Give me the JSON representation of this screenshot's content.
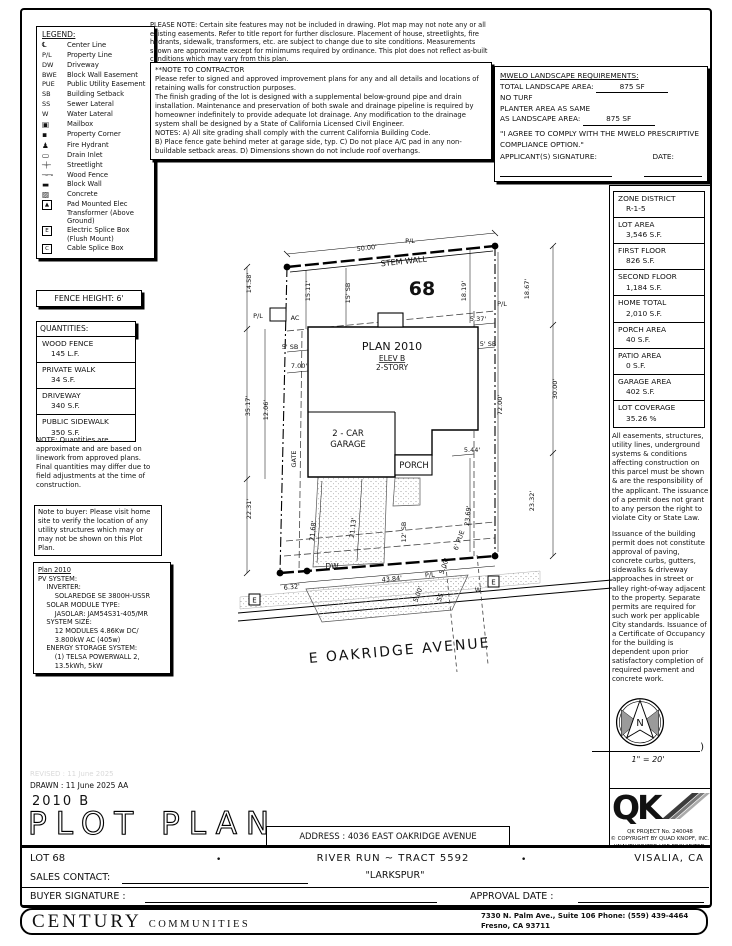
{
  "legend": {
    "title": "LEGEND:",
    "items": [
      {
        "sym": "℄",
        "label": "Center Line"
      },
      {
        "sym": "P/L",
        "cls": "sm",
        "label": "Property Line"
      },
      {
        "sym": "DW",
        "cls": "sm",
        "label": "Driveway"
      },
      {
        "sym": "BWE",
        "cls": "sm",
        "label": "Block Wall Easement"
      },
      {
        "sym": "PUE",
        "cls": "sm",
        "label": "Public Utility Easement"
      },
      {
        "sym": "SB",
        "cls": "sm",
        "label": "Building Setback"
      },
      {
        "sym": "SS",
        "cls": "sm",
        "label": "Sewer Lateral"
      },
      {
        "sym": "W",
        "cls": "sm",
        "label": "Water Lateral"
      },
      {
        "sym": "▣",
        "cls": "ic",
        "label": "Mailbox"
      },
      {
        "sym": "▪",
        "cls": "ic",
        "label": "Property Corner"
      },
      {
        "sym": "♟",
        "cls": "ic",
        "label": "Fire Hydrant"
      },
      {
        "sym": "▭",
        "cls": "ic",
        "label": "Drain Inlet"
      },
      {
        "sym": "─┼─",
        "cls": "tiny",
        "label": "Streetlight"
      },
      {
        "sym": "─∘─∘",
        "cls": "tiny",
        "label": "Wood Fence"
      },
      {
        "sym": "▬",
        "cls": "ic",
        "label": "Block Wall"
      },
      {
        "sym": "▨",
        "cls": "ic",
        "label": "Concrete"
      },
      {
        "sym": "▲",
        "cls": "bx",
        "label": "Pad Mounted Elec Transformer (Above Ground)"
      },
      {
        "sym": "E",
        "cls": "bx",
        "label": "Electric Splice Box (Flush Mount)"
      },
      {
        "sym": "C",
        "cls": "bx",
        "label": "Cable Splice Box"
      }
    ]
  },
  "top_note": "PLEASE NOTE:  Certain site features may not be included in drawing.  Plot map may not note any or all existing easements.  Refer to title report for further disclosure.  Placement of house, streetlights, fire hydrants, sidewalk, transformers, etc. are subject to change due to site conditions.  Measurements shown are approximate except for minimums required by ordinance.  This plot does not reflect as-built conditions which may vary from this plan.",
  "contractor": {
    "title": "**NOTE TO CONTRACTOR",
    "paras": [
      "Please refer to signed and approved improvement plans for any and all details and locations of retaining walls for construction purposes.",
      "The finish grading of the lot is designed with a supplemental below-ground pipe and drain installation.  Maintenance and preservation of both swale and drainage pipeline is required by homeowner indefinitely to provide adequate lot drainage.  Any modification to the drainage system shall be designed by a State of California Licensed Civil Engineer.",
      "NOTES:  A) All site grading shall comply with the current California Building Code.",
      "B) Place fence gate behind meter at garage side, typ.  C) Do not place A/C pad in any non-buildable setback areas.  D) Dimensions shown do not include roof overhangs."
    ]
  },
  "mwelo": {
    "title": "MWELO LANDSCAPE REQUIREMENTS:",
    "row1_label": "TOTAL LANDSCAPE AREA:",
    "row1_value": "875 SF",
    "row2": "NO TURF",
    "row3a": "PLANTER AREA AS SAME",
    "row3b": "AS LANDSCAPE AREA:",
    "row3_value": "875 SF",
    "quote": "\"I AGREE TO COMPLY WITH THE MWELO PRESCRIPTIVE COMPLIANCE OPTION.\"",
    "sig_label": "APPLICANT(S) SIGNATURE:",
    "date_label": "DATE:"
  },
  "zone_table": {
    "rows": [
      {
        "label": "ZONE DISTRICT",
        "value": "R-1-5"
      },
      {
        "label": "LOT AREA",
        "value": "3,546 S.F."
      },
      {
        "label": "FIRST FLOOR",
        "value": "826 S.F."
      },
      {
        "label": "SECOND FLOOR",
        "value": "1,184 S.F."
      },
      {
        "label": "HOME TOTAL",
        "value": "2,010 S.F."
      },
      {
        "label": "PORCH AREA",
        "value": "40 S.F."
      },
      {
        "label": "PATIO AREA",
        "value": "0 S.F."
      },
      {
        "label": "GARAGE AREA",
        "value": "402 S.F."
      },
      {
        "label": "LOT COVERAGE",
        "value": "35.26 %"
      }
    ]
  },
  "right_notes": {
    "p1": "All easements, structures, utility lines, underground systems & conditions affecting construction on this parcel must be shown & are the responsibility of the applicant. The issuance of a permit does not grant to any person the right to violate City or State Law.",
    "p2": "Issuance of the building permit does not constitute approval of paving, concrete curbs, gutters, sidewalks & driveway approaches in street or alley right-of-way adjacent to the property. Separate permits are required for such work per applicable City standards. Issuance of a Certificate of Occupancy for the building is dependent upon prior satisfactory completion of required pavement and concrete work."
  },
  "fence": "FENCE HEIGHT: 6'",
  "quantities": {
    "title": "QUANTITIES:",
    "rows": [
      {
        "label": "WOOD FENCE",
        "value": "145 L.F."
      },
      {
        "label": "PRIVATE WALK",
        "value": "34 S.F."
      },
      {
        "label": "DRIVEWAY",
        "value": "340 S.F."
      },
      {
        "label": "PUBLIC SIDEWALK",
        "value": "350 S.F."
      }
    ]
  },
  "quantities_note": "NOTE: Quantities are approximate and are based on linework from approved plans. Final quantities may differ due to field adjustments at the time of construction.",
  "buyer_note": "Note to buyer: Please visit home site to verify the location of any utility structures which may or may not be shown on this Plot Plan.",
  "pv": {
    "lines": [
      "Plan 2010",
      "PV SYSTEM:",
      "    INVERTER:",
      "        SOLAREDGE SE 3800H-USSR",
      "    SOLAR MODULE TYPE:",
      "        JASOLAR: JAM54S31-405/MR",
      "    SYSTEM SIZE:",
      "        12 MODULES 4.86Kw DC/",
      "        3.800kW AC (405w)",
      "    ENERGY STORAGE SYSTEM:",
      "        (1) TELSA POWERWALL 2,",
      "        13.5kWh, 5kW"
    ]
  },
  "plot": {
    "lot_number": "68",
    "d50": "50.00'",
    "stem": "STEM WALL",
    "pl": "P/L",
    "ac": "AC",
    "d1458": "14.58'",
    "d1511": "15.11'",
    "d15sb": "15' SB",
    "d1819": "18.19'",
    "d1867": "18.67'",
    "d537": "5.37'",
    "d5sb": "5' SB",
    "plan": "PLAN 2010",
    "elev": "ELEV B",
    "story": "2-STORY",
    "d700": "7.00'",
    "d3517": "35.17'",
    "d1206": "12.06'",
    "d7200": "72.00'",
    "d3000": "30.00'",
    "garage1": "2 - CAR",
    "garage2": "GARAGE",
    "gate": "GATE",
    "d544": "5.44'",
    "porch": "PORCH",
    "d2231": "22.31'",
    "d2168": "21.68'",
    "d2113": "21.13'",
    "d12sb": "12' SB",
    "d2369": "23.69'",
    "d2332": "23.32'",
    "d6pue": "6' PUE",
    "d500": "5.00'",
    "dw": "DW",
    "d632": "6.32'",
    "d4384": "43.84'",
    "ss": "SS",
    "w": "W",
    "e": "E",
    "street": "E OAKRIDGE AVENUE"
  },
  "compass": {
    "n": "N",
    "scale": "1\" = 20'"
  },
  "qk": {
    "logo": "QK",
    "project": "QK PROJECT No. 240048",
    "copyright": "©  COPYRIGHT BY QUAD KNOPF, INC.",
    "prohibited": "UNAUTHORIZED USE PROHIBITED."
  },
  "title_block": {
    "revised": "REVISED :  11 June 2025",
    "drawn": "DRAWN :  11 June 2025   AA",
    "plan_code": "2010  B",
    "sheet_title": "PLOT PLAN",
    "address": "ADDRESS :  4036 EAST OAKRIDGE AVENUE",
    "lot": "LOT 68",
    "bullet": "•",
    "tract": "RIVER RUN ~ TRACT 5592",
    "subdivision": "\"LARKSPUR\"",
    "city": "VISALIA, CA",
    "sales_contact": "SALES CONTACT:",
    "buyer_signature": "BUYER SIGNATURE :",
    "approval_date": "APPROVAL DATE :"
  },
  "footer": {
    "brand": "CENTURY",
    "brand_sub": "COMMUNITIES",
    "addr1": "7330 N. Palm Ave., Suite 106    Phone:  (559) 439-4464",
    "addr2": "Fresno, CA  93711"
  }
}
